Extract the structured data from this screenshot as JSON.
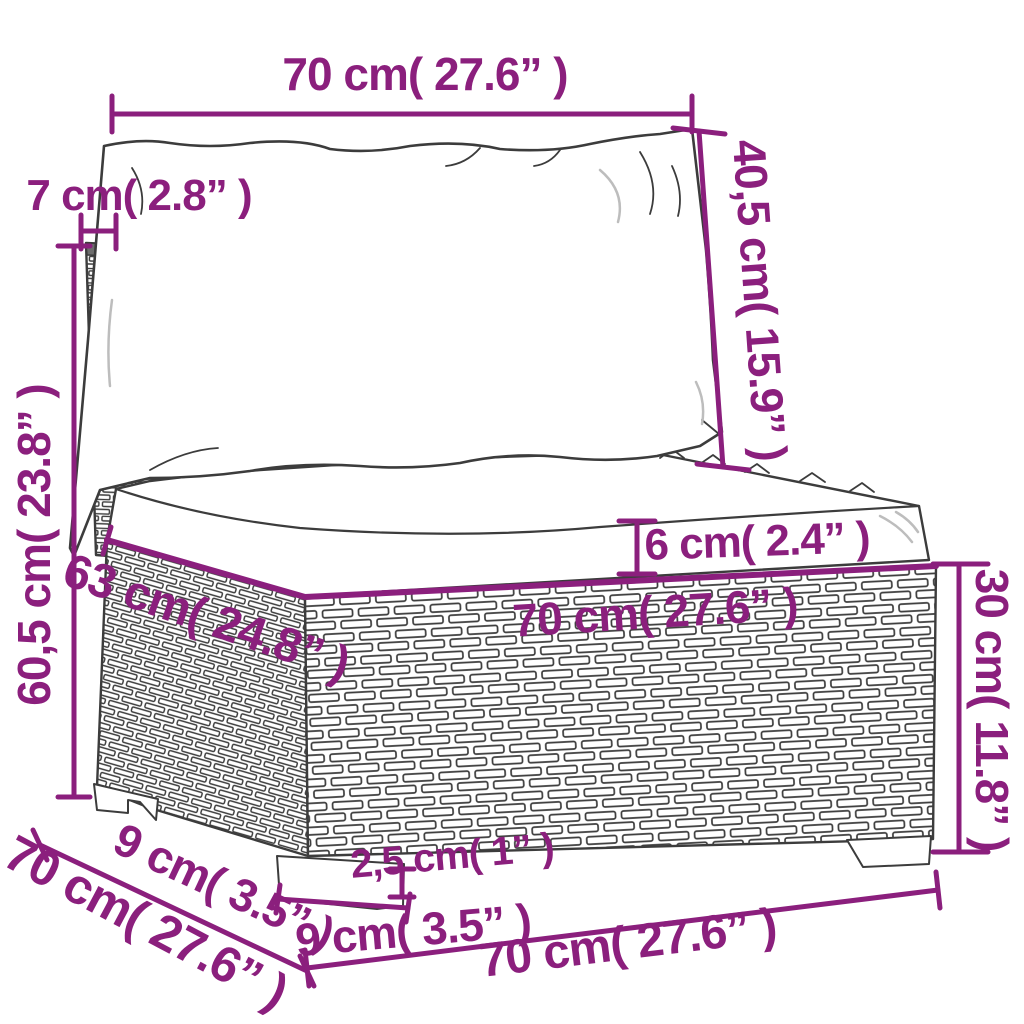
{
  "diagram": {
    "kind": "product-dimension-diagram",
    "subject": "poly-rattan garden middle sofa section with back and seat cushions",
    "colors": {
      "dimension_accent": "#8b1f7d",
      "line_art": "#3c3c3c",
      "background": "#ffffff"
    }
  },
  "annotations": {
    "cushion_width_top": "70 cm( 27.6” )",
    "back_post_width": "7 cm( 2.8” )",
    "overall_height": "60,5 cm( 23.8” )",
    "back_cushion_height": "40,5 cm( 15.9” )",
    "seat_cushion_thickness": "6 cm( 2.4” )",
    "seat_depth_top": "63 cm( 24.8” )",
    "seat_width_front": "70 cm( 27.6” )",
    "base_height": "30 cm( 11.8” )",
    "leg_side_width": "9 cm( 3.5” )",
    "base_depth_bottom": "70 cm( 27.6” )",
    "leg_front_width": "9 cm( 3.5” )",
    "leg_height": "2,5 cm( 1” )",
    "base_width_bottom": "70 cm( 27.6” )"
  }
}
